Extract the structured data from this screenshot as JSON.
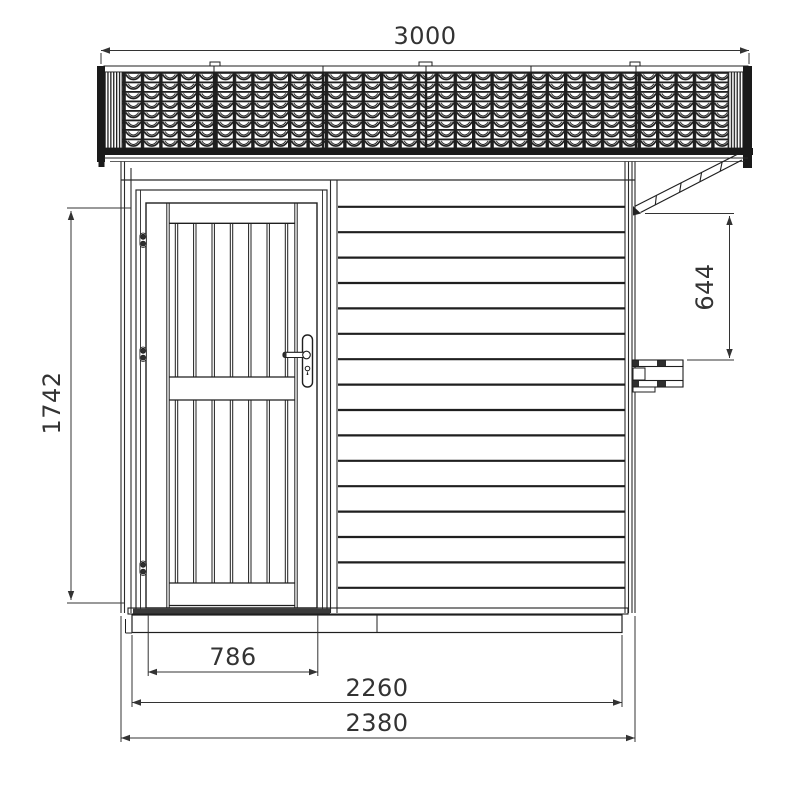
{
  "drawing": {
    "type": "technical-elevation",
    "subject": "shed-front-elevation",
    "background_color": "#ffffff",
    "line_color": "#1f1f1f",
    "dimension_color": "#333333",
    "dimensions": {
      "roof_width": "3000",
      "door_height": "1742",
      "side_canopy_drop": "644",
      "door_width": "786",
      "base_width": "2260",
      "overall_width": "2380"
    }
  }
}
